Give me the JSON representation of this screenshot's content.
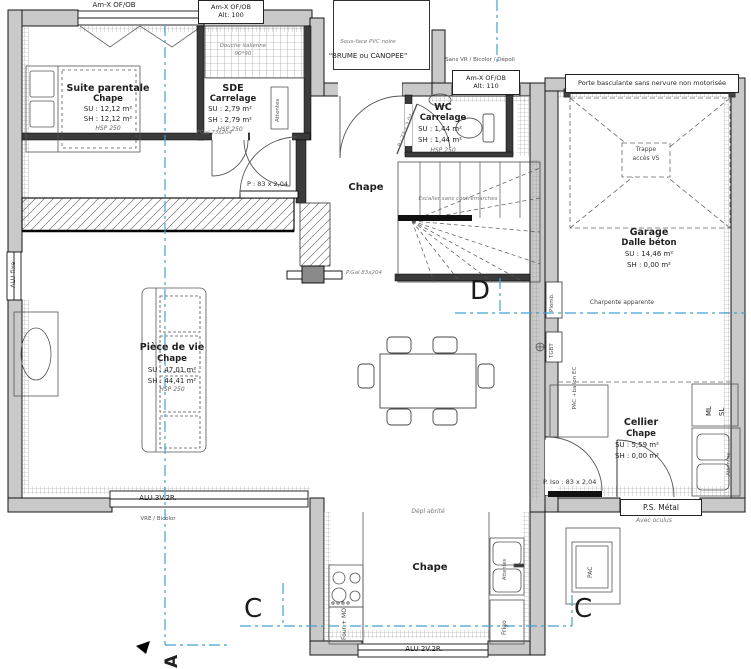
{
  "colors": {
    "wall": "#c9c9c9",
    "interior_wall": "#3b3b3b",
    "section_blue": "#43a0d2",
    "line": "#222222"
  },
  "windows": {
    "top_left_label": "Am-X OF/OB",
    "alt100_l1": "Am-X OF/OB",
    "alt100_l2": "Alt: 100",
    "alt110_l1": "Am-X OF/OB",
    "alt110_l2": "Alt: 110",
    "entry_note": "Sans VR / Bicolor / Dépoli",
    "left_fixed": "ALU fixe",
    "living_bottom": "ALU 3V.2R.",
    "living_bottom_note": "VRE / Bicolor",
    "kitchen_bottom": "ALU 2V.2R."
  },
  "porch": {
    "soffit": "Sous-face PVC noire",
    "name": "\"BRUME ou CANOPEE\""
  },
  "rooms": {
    "suite": {
      "name": "Suite parentale",
      "floor": "Chape",
      "su": "SU : 12,12 m²",
      "sh": "SH : 12,12 m²",
      "hsp": "HSP 250"
    },
    "sde": {
      "name": "SDE",
      "floor": "Carrelage",
      "su": "SU : 2,79 m²",
      "sh": "SH : 2,79 m²",
      "hsp": "HSP 250",
      "shower": "Douche italienne",
      "shower_dim": "90*90",
      "attentes": "Attentes",
      "door": "P.Gal 73x204"
    },
    "wc": {
      "name": "WC",
      "floor": "Carrelage",
      "su": "SU : 1,44 m²",
      "sh": "SH : 1,44 m²",
      "hsp": "HSP 250",
      "door": "P : 73 x 2,04"
    },
    "hall": {
      "floor": "Chape",
      "door_living": "P : 83 x 2,04",
      "door_gal": "P.Gal 83x204"
    },
    "stairs": {
      "note": "Escalier sans contremarches"
    },
    "living": {
      "name": "Pièce de vie",
      "floor": "Chape",
      "su": "SU : 47,01 m²",
      "sh": "SH : 44,41 m²",
      "hsp": "HSP 250"
    },
    "kitchen": {
      "floor": "Chape",
      "note": "Dépl abrité",
      "four": "Four + MO",
      "frigo": "Frigo",
      "attentes": "Attentes"
    },
    "cellier": {
      "name": "Cellier",
      "floor": "Chape",
      "su": "SU : 5,59 m²",
      "sh": "SH : 0,00 m²",
      "pac1": "PAC",
      "pac2": "+ballon EC",
      "ml": "ML",
      "sl": "SL",
      "attentes": "Attentes",
      "door_iso": "P. Iso : 83 x 2,04",
      "door_ps": "P.S. Métal",
      "door_ps_note": "Avec oculus"
    },
    "garage": {
      "name": "Garage",
      "floor": "Dalle béton",
      "su": "SU : 14,46 m²",
      "sh": "SH : 0,00 m²",
      "door": "Porte basculante sans nervure non motorisée",
      "trappe1": "Trappe",
      "trappe2": "accès VS",
      "charpente": "Charpente apparente",
      "plomb": "Plomb.",
      "tgbt": "TGBT"
    }
  },
  "exterior": {
    "pac": "PAC"
  },
  "sections": {
    "a": "A",
    "c": "C",
    "d": "D"
  }
}
